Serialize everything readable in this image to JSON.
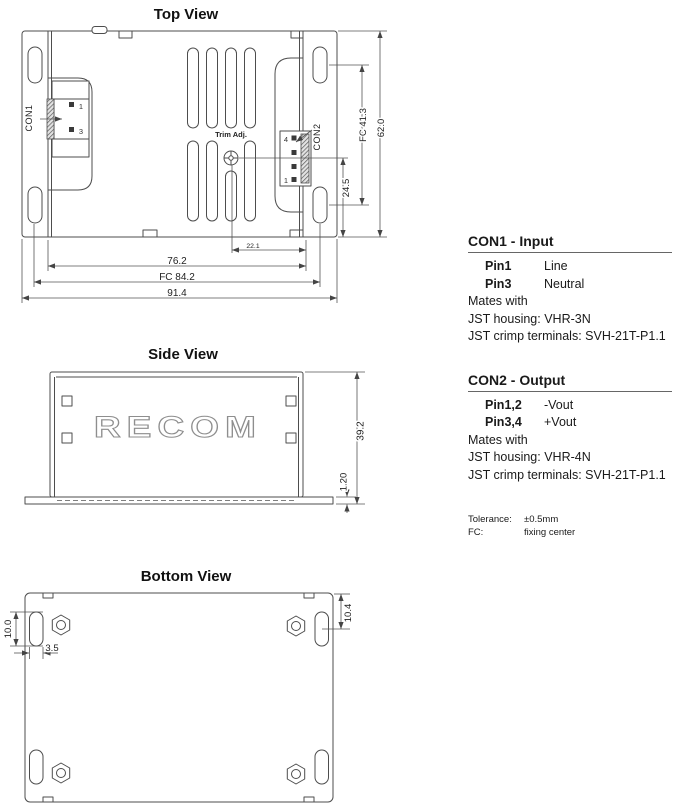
{
  "views": {
    "top": {
      "title": "Top View",
      "labels": {
        "con1": "CON1",
        "con2": "CON2",
        "trim": "Trim Adj."
      },
      "pins": {
        "con1_top": "1",
        "con1_bottom": "3",
        "con2_top": "4",
        "con2_bottom": "1"
      },
      "dims": {
        "trim_offset": "22.1",
        "body_width": "76.2",
        "fixing_width": "FC 84.2",
        "overall_width": "91.4",
        "trim_to_base": "24.5",
        "fixing_depth": "FC 41.3",
        "overall_depth": "62.0"
      }
    },
    "side": {
      "title": "Side View",
      "logo": "RECOM",
      "dims": {
        "height": "39.2",
        "base_thickness": "1.20"
      }
    },
    "bottom": {
      "title": "Bottom View",
      "dims": {
        "slot_length": "10.0",
        "slot_width": "3.5",
        "slot_offset": "10.4"
      }
    }
  },
  "notes": {
    "con1": {
      "heading": "CON1 - Input",
      "pins": [
        {
          "pin": "Pin1",
          "signal": "Line"
        },
        {
          "pin": "Pin3",
          "signal": "Neutral"
        }
      ],
      "mates": "Mates with",
      "housing": "JST housing: VHR-3N",
      "crimp": "JST crimp terminals: SVH-21T-P1.1"
    },
    "con2": {
      "heading": "CON2 - Output",
      "pins": [
        {
          "pin": "Pin1,2",
          "signal": "-Vout"
        },
        {
          "pin": "Pin3,4",
          "signal": "+Vout"
        }
      ],
      "mates": "Mates with",
      "housing": "JST housing: VHR-4N",
      "crimp": "JST crimp terminals: SVH-21T-P1.1"
    },
    "footnotes": [
      {
        "label": "Tolerance:",
        "value": "±0.5mm"
      },
      {
        "label": "FC:",
        "value": "fixing center"
      }
    ]
  },
  "colors": {
    "line": "#4d4d4d",
    "dimension_line": "#555555",
    "text": "#1a1a1a",
    "logo_outline": "#8e8e8e",
    "background": "#ffffff"
  }
}
